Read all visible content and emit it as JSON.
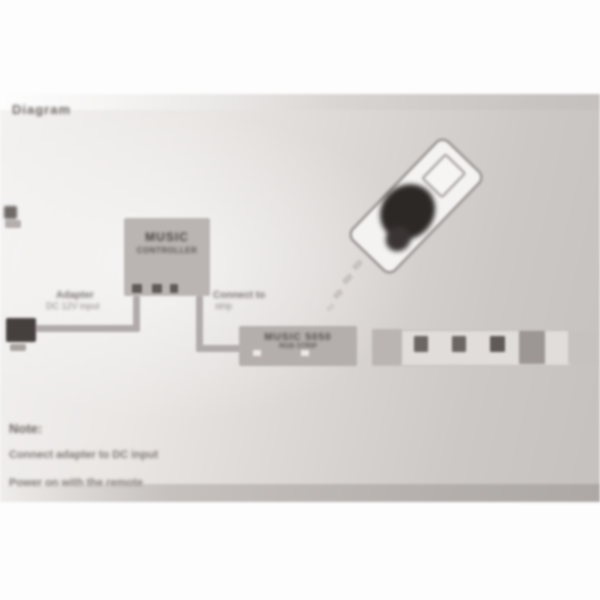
{
  "sheet": {
    "kind": "photographed LED strip-light instruction sheet (out of focus)",
    "title": "Diagram"
  },
  "diagram": {
    "controller": {
      "line1": "MUSIC",
      "line2": "CONTROLLER"
    },
    "adapter_label": {
      "line1": "Adapter",
      "line2": "DC 12V input"
    },
    "output_label": {
      "line1": "Connect to",
      "line2": "strip"
    },
    "strip_connector": {
      "line1": "MUSIC 5050",
      "line2": "RGB STRIP"
    }
  },
  "notes": {
    "title": "Note:",
    "line1": "Connect adapter to DC input",
    "line2": "Power on with the remote"
  },
  "colors": {
    "paper_light": "#f4f2f1",
    "paper_dark": "#c5c1bf",
    "ink_dark": "#453f3d",
    "ink_mid": "#7b7573",
    "box_gray": "#bab5b3",
    "plug_dark": "#453f3d",
    "remote_button_pad": "#2c2826"
  }
}
